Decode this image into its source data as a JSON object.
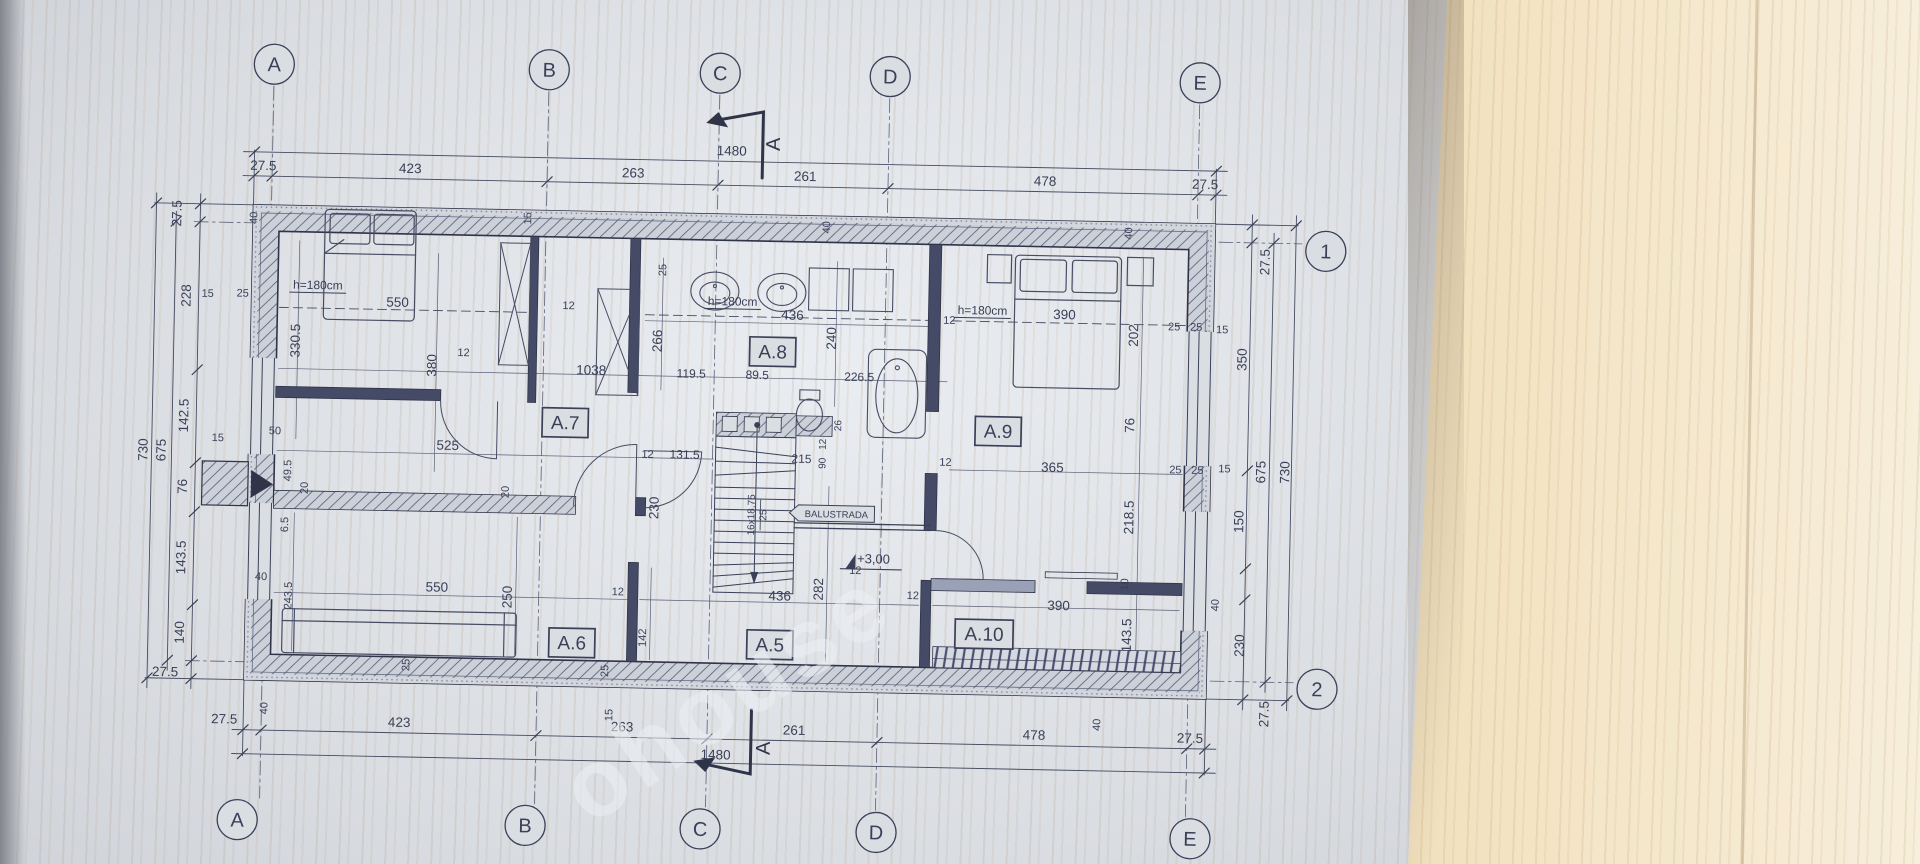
{
  "watermark": "ohouse",
  "palette": {
    "paper": "#dadde2",
    "ink": "#3a4058",
    "dim": "#464c62",
    "wood": "#e4c497",
    "deck_hatch": "#4b5175"
  },
  "section_markers": {
    "top": "A",
    "bottom": "A"
  },
  "grid": {
    "top": [
      {
        "label": "A",
        "x": 267
      },
      {
        "label": "B",
        "x": 542
      },
      {
        "label": "C",
        "x": 713
      },
      {
        "label": "D",
        "x": 883
      },
      {
        "label": "E",
        "x": 1193
      }
    ],
    "bottom": [
      {
        "label": "A",
        "x": 245
      },
      {
        "label": "B",
        "x": 533
      },
      {
        "label": "C",
        "x": 708
      },
      {
        "label": "D",
        "x": 884
      },
      {
        "label": "E",
        "x": 1198
      }
    ],
    "right": [
      {
        "label": "1",
        "y": 230
      },
      {
        "label": "2",
        "y": 668
      }
    ]
  },
  "rooms": [
    {
      "id": "A.7",
      "x": 565,
      "y": 417
    },
    {
      "id": "A.8",
      "x": 771,
      "y": 342
    },
    {
      "id": "A.9",
      "x": 998,
      "y": 417
    },
    {
      "id": "A.10",
      "x": 988,
      "y": 620
    },
    {
      "id": "A.5",
      "x": 774,
      "y": 635
    },
    {
      "id": "A.6",
      "x": 576,
      "y": 637
    }
  ],
  "annotations": [
    {
      "t": "1480",
      "x": 726,
      "y": 146
    },
    {
      "t": "27.5",
      "x": 258,
      "y": 170
    },
    {
      "t": "423",
      "x": 405,
      "y": 170
    },
    {
      "t": "263",
      "x": 628,
      "y": 170
    },
    {
      "t": "261",
      "x": 800,
      "y": 170
    },
    {
      "t": "478",
      "x": 1040,
      "y": 170
    },
    {
      "t": "27.5",
      "x": 1200,
      "y": 170
    },
    {
      "t": "15",
      "x": 527,
      "y": 213,
      "r": -90,
      "fs": 11
    },
    {
      "t": "40",
      "x": 253,
      "y": 218,
      "r": -90,
      "fs": 11
    },
    {
      "t": "40",
      "x": 826,
      "y": 216,
      "r": -90,
      "fs": 11
    },
    {
      "t": "40",
      "x": 1128,
      "y": 216,
      "r": -90,
      "fs": 11
    },
    {
      "t": "27.5",
      "x": 230,
      "y": 724
    },
    {
      "t": "423",
      "x": 405,
      "y": 724
    },
    {
      "t": "263",
      "x": 628,
      "y": 724
    },
    {
      "t": "261",
      "x": 800,
      "y": 724
    },
    {
      "t": "478",
      "x": 1040,
      "y": 724
    },
    {
      "t": "27.5",
      "x": 1196,
      "y": 724
    },
    {
      "t": "1480",
      "x": 722,
      "y": 750
    },
    {
      "t": "40",
      "x": 273,
      "y": 708,
      "r": -90,
      "fs": 11
    },
    {
      "t": "40",
      "x": 1106,
      "y": 708,
      "r": -90,
      "fs": 11
    },
    {
      "t": "15",
      "x": 618,
      "y": 708,
      "r": -90,
      "fs": 11
    },
    {
      "t": "25",
      "x": 613,
      "y": 664,
      "r": -90,
      "fs": 11
    },
    {
      "t": "142",
      "x": 650,
      "y": 630,
      "r": -90,
      "fs": 11
    },
    {
      "t": "12",
      "x": 621,
      "y": 588,
      "fs": 11
    },
    {
      "t": "12",
      "x": 916,
      "y": 586,
      "fs": 11
    },
    {
      "t": "27.5",
      "x": 177,
      "y": 215,
      "r": -90
    },
    {
      "t": "228",
      "x": 188,
      "y": 297,
      "r": -90
    },
    {
      "t": "142.5",
      "x": 188,
      "y": 417,
      "r": -90
    },
    {
      "t": "76",
      "x": 188,
      "y": 488,
      "r": -90
    },
    {
      "t": "143.5",
      "x": 188,
      "y": 559,
      "r": -90
    },
    {
      "t": "140",
      "x": 188,
      "y": 634,
      "r": -90
    },
    {
      "t": "27.5",
      "x": 170,
      "y": 678
    },
    {
      "t": "675",
      "x": 166,
      "y": 452,
      "r": -90
    },
    {
      "t": "730",
      "x": 148,
      "y": 452,
      "r": -90
    },
    {
      "t": "15",
      "x": 205,
      "y": 298,
      "fs": 11
    },
    {
      "t": "25",
      "x": 240,
      "y": 297,
      "fs": 11
    },
    {
      "t": "330.5",
      "x": 298,
      "y": 340,
      "r": -90
    },
    {
      "t": "50",
      "x": 275,
      "y": 434,
      "fs": 11
    },
    {
      "t": "15",
      "x": 218,
      "y": 442,
      "fs": 11
    },
    {
      "t": "49.5",
      "x": 292,
      "y": 470,
      "r": -90,
      "fs": 11
    },
    {
      "t": "20",
      "x": 309,
      "y": 487,
      "r": -90,
      "fs": 11
    },
    {
      "t": "6.5",
      "x": 290,
      "y": 524,
      "r": -90,
      "fs": 11
    },
    {
      "t": "40",
      "x": 264,
      "y": 580,
      "fs": 11
    },
    {
      "t": "243.5",
      "x": 295,
      "y": 595,
      "r": -90,
      "fs": 11
    },
    {
      "t": "27.5",
      "x": 1266,
      "y": 242,
      "r": -90
    },
    {
      "t": "350",
      "x": 1245,
      "y": 340,
      "r": -90
    },
    {
      "t": "15",
      "x": 1220,
      "y": 314,
      "fs": 11
    },
    {
      "t": "675",
      "x": 1266,
      "y": 452,
      "r": -90
    },
    {
      "t": "730",
      "x": 1290,
      "y": 452,
      "r": -90
    },
    {
      "t": "150",
      "x": 1245,
      "y": 502,
      "r": -90
    },
    {
      "t": "40",
      "x": 1222,
      "y": 586,
      "r": -90,
      "fs": 11
    },
    {
      "t": "230",
      "x": 1248,
      "y": 626,
      "r": -90
    },
    {
      "t": "27.5",
      "x": 1274,
      "y": 694,
      "r": -90
    },
    {
      "t": "25",
      "x": 1172,
      "y": 312,
      "fs": 11
    },
    {
      "t": "25",
      "x": 1194,
      "y": 312,
      "fs": 11
    },
    {
      "t": "25",
      "x": 1176,
      "y": 455,
      "fs": 11
    },
    {
      "t": "25",
      "x": 1198,
      "y": 455,
      "fs": 11
    },
    {
      "t": "15",
      "x": 1225,
      "y": 453,
      "fs": 11
    },
    {
      "t": "h=180cm",
      "x": 315,
      "y": 288,
      "u": 1,
      "fs": 12
    },
    {
      "t": "550",
      "x": 395,
      "y": 304
    },
    {
      "t": "380",
      "x": 435,
      "y": 362,
      "r": -90
    },
    {
      "t": "12",
      "x": 462,
      "y": 352,
      "fs": 11
    },
    {
      "t": "1038",
      "x": 590,
      "y": 368
    },
    {
      "t": "119.5",
      "x": 690,
      "y": 369,
      "fs": 12
    },
    {
      "t": "89.5",
      "x": 756,
      "y": 369,
      "fs": 12
    },
    {
      "t": "226.5",
      "x": 858,
      "y": 369,
      "fs": 12
    },
    {
      "t": "525",
      "x": 448,
      "y": 446
    },
    {
      "t": "131.5",
      "x": 685,
      "y": 450,
      "fs": 12
    },
    {
      "t": "12",
      "x": 648,
      "y": 450,
      "fs": 11
    },
    {
      "t": "230",
      "x": 660,
      "y": 500,
      "r": -90
    },
    {
      "t": "20",
      "x": 510,
      "y": 487,
      "r": -90,
      "fs": 11
    },
    {
      "t": "550",
      "x": 440,
      "y": 588
    },
    {
      "t": "250",
      "x": 515,
      "y": 592,
      "r": -90
    },
    {
      "t": "25",
      "x": 414,
      "y": 662,
      "r": -90,
      "fs": 11
    },
    {
      "t": "436",
      "x": 783,
      "y": 590
    },
    {
      "t": "282",
      "x": 826,
      "y": 578,
      "r": -90
    },
    {
      "t": "436",
      "x": 790,
      "y": 309
    },
    {
      "t": "266",
      "x": 660,
      "y": 333,
      "r": -90
    },
    {
      "t": "240",
      "x": 834,
      "y": 327,
      "r": -90
    },
    {
      "t": "25",
      "x": 663,
      "y": 262,
      "r": -90,
      "fs": 11
    },
    {
      "t": "12",
      "x": 566,
      "y": 303,
      "fs": 11
    },
    {
      "t": "h=180cm",
      "x": 730,
      "y": 296,
      "u": 1,
      "fs": 12
    },
    {
      "t": "12",
      "x": 947,
      "y": 310,
      "fs": 11
    },
    {
      "t": "h=180cm",
      "x": 980,
      "y": 300,
      "u": 1,
      "fs": 12
    },
    {
      "t": "390",
      "x": 1062,
      "y": 303
    },
    {
      "t": "202",
      "x": 1136,
      "y": 318,
      "r": -90
    },
    {
      "t": "76",
      "x": 1134,
      "y": 408,
      "r": -90
    },
    {
      "t": "365",
      "x": 1053,
      "y": 456
    },
    {
      "t": "12",
      "x": 946,
      "y": 452,
      "fs": 11
    },
    {
      "t": "215",
      "x": 802,
      "y": 452,
      "fs": 12
    },
    {
      "t": "90",
      "x": 826,
      "y": 452,
      "r": -90,
      "fs": 10
    },
    {
      "t": "12",
      "x": 826,
      "y": 433,
      "r": -90,
      "fs": 10
    },
    {
      "t": "26",
      "x": 841,
      "y": 414,
      "r": -90,
      "fs": 10
    },
    {
      "t": "16x18,75",
      "x": 756,
      "y": 505,
      "r": -90,
      "fs": 10
    },
    {
      "t": "25",
      "x": 768,
      "y": 505,
      "r": -90,
      "fs": 10
    },
    {
      "t": "218.5",
      "x": 1135,
      "y": 500,
      "r": -90
    },
    {
      "t": "10",
      "x": 1131,
      "y": 567,
      "r": -90,
      "fs": 11
    },
    {
      "t": "143.5",
      "x": 1135,
      "y": 618,
      "r": -90
    },
    {
      "t": "390",
      "x": 1062,
      "y": 594
    },
    {
      "t": "12",
      "x": 858,
      "y": 562,
      "fs": 11
    },
    {
      "t": "+3,00",
      "x": 876,
      "y": 551,
      "fs": 13
    },
    {
      "t": "BALUSTRADA",
      "x": 838,
      "y": 506,
      "fs": 9.5
    }
  ]
}
